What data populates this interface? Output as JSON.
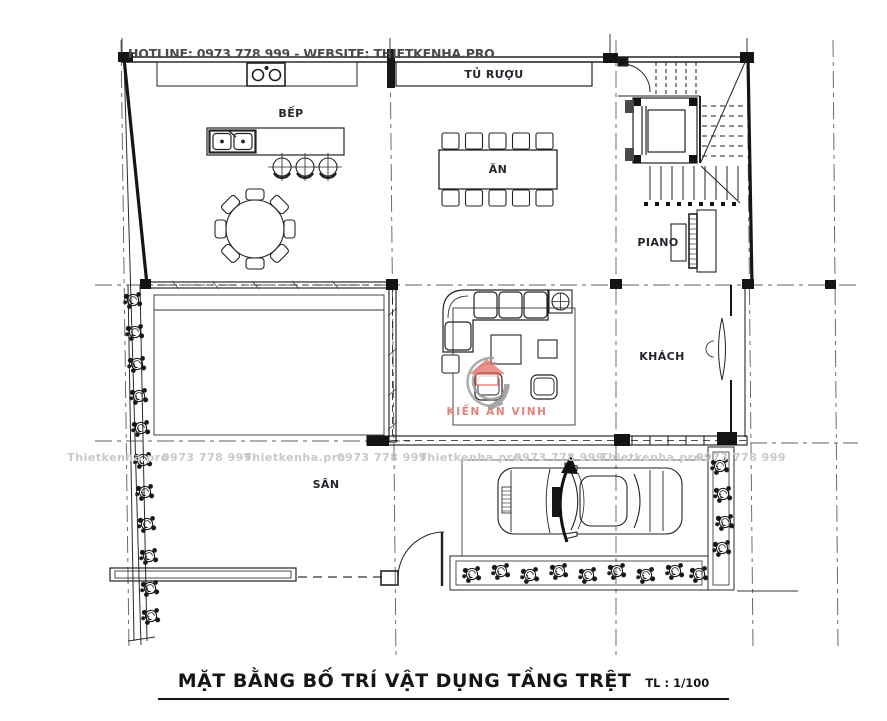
{
  "header": {
    "hotline": "HOTLINE: 0973 778 999 - WEBSITE: THIETKENHA.PRO"
  },
  "rooms": {
    "kitchen": "BẾP",
    "wine_cabinet": "TỦ RƯỢU",
    "dining": "ĂN",
    "piano": "PIANO",
    "living": "KHÁCH",
    "yard": "SÂN"
  },
  "watermark": {
    "logo_text": "KIẾN AN VINH",
    "row": [
      "Thietkenha.pro",
      "0973 778 999",
      "Thietkenha.pro",
      "0973 778 999",
      "Thietkenha.pro",
      "0973 778 999",
      "Thietkenha.pro",
      "0973 778 999"
    ]
  },
  "title": {
    "main": "MẶT BẰNG BỐ TRÍ VẬT DỤNG TẦNG TRỆT",
    "scale": "TL : 1/100"
  },
  "colors": {
    "line": "#161616",
    "grid": "#5c5c5c",
    "header_text": "#4a4a4a",
    "watermark_gray": "#c9c9c9",
    "logo_red": "#e2625a"
  }
}
